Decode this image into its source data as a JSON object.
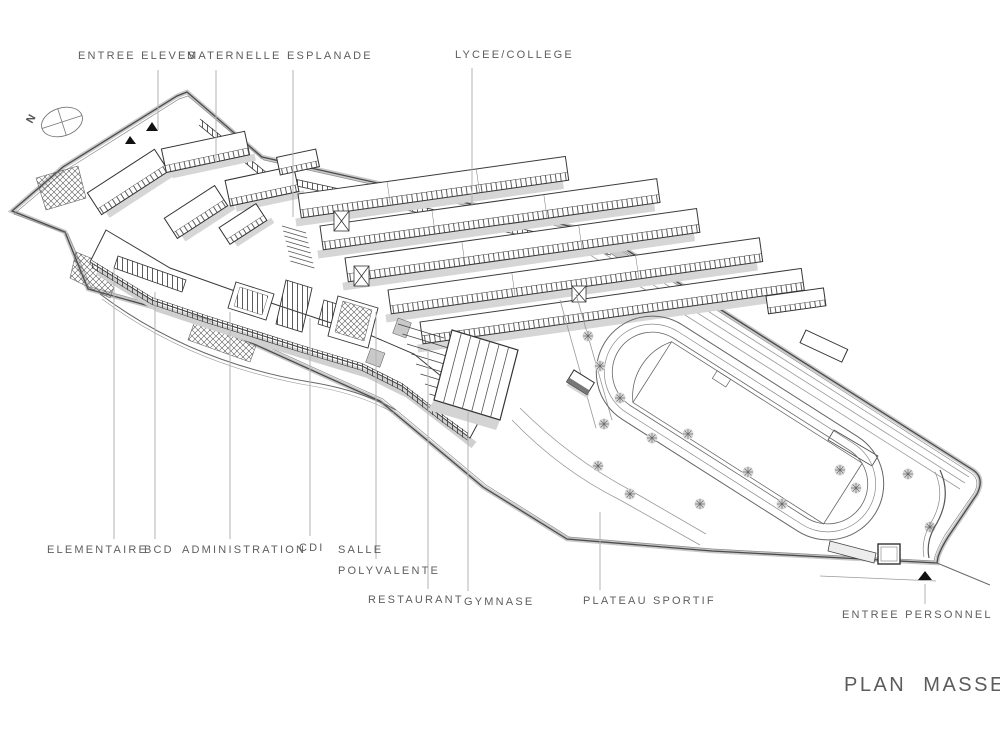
{
  "title": "PLAN MASSE",
  "compass": {
    "north_label": "N"
  },
  "labels": {
    "entree_eleves": "ENTREE ELEVES",
    "maternelle": "MATERNELLE",
    "esplanade": "ESPLANADE",
    "lycee_college": "LYCEE/COLLEGE",
    "elementaire": "ELEMENTAIRE",
    "bcd": "BCD",
    "administration": "ADMINISTRATION",
    "cdi": "CDI",
    "salle_polyvalente_line1": "SALLE",
    "salle_polyvalente_line2": "POLYVALENTE",
    "restaurant": "RESTAURANT",
    "gymnase": "GYMNASE",
    "plateau_sportif": "PLATEAU SPORTIF",
    "entree_personnel": "ENTREE PERSONNEL"
  },
  "icons": {
    "compass": "north-compass-icon",
    "student_entrance": "entrance-arrow-icon",
    "staff_entrance": "entrance-arrow-icon",
    "trees": "tree-icon"
  },
  "colors": {
    "linework": "#3a3a3a",
    "label_text": "#5e5e5e",
    "leader_line": "#b3b3b3",
    "shadow": "#d4d4d4",
    "background": "#ffffff"
  }
}
